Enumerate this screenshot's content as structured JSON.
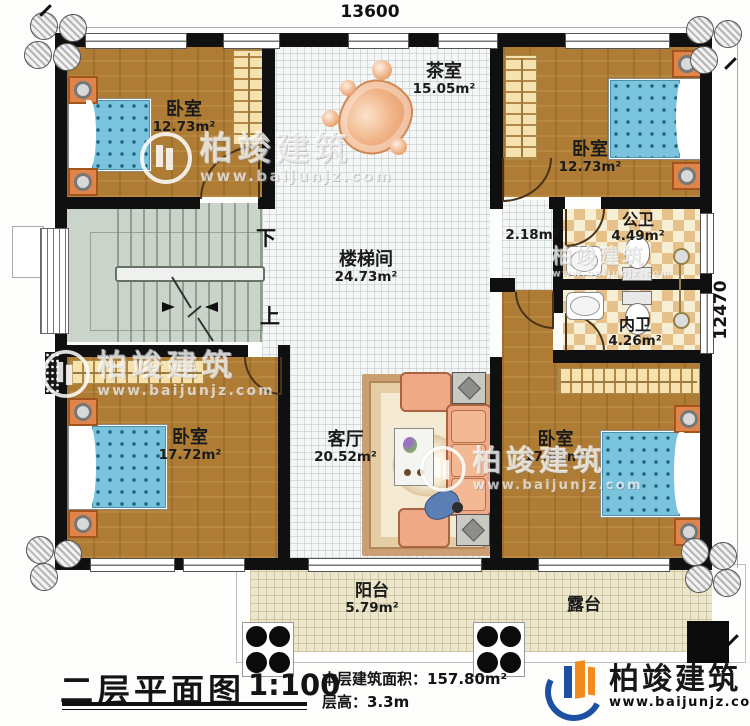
{
  "plan": {
    "dim_top": "13600",
    "dim_right": "12470",
    "rooms": {
      "bedroom_tl": {
        "name": "卧室",
        "area": "12.73m²"
      },
      "tea_room": {
        "name": "茶室",
        "area": "15.05m²"
      },
      "bedroom_tr": {
        "name": "卧室",
        "area": "12.73m²"
      },
      "stairwell": {
        "name": "楼梯间",
        "area": "24.73m²",
        "down_label": "下",
        "up_label": "上"
      },
      "hallway": {
        "area": "2.18m²"
      },
      "public_bathroom": {
        "name": "公卫",
        "area": "4.49m²"
      },
      "ensuite_bathroom": {
        "name": "内卫",
        "area": "4.26m²"
      },
      "bedroom_bl": {
        "name": "卧室",
        "area": "17.72m²"
      },
      "living_room": {
        "name": "客厅",
        "area": "20.52m²"
      },
      "bedroom_br": {
        "name": "卧室",
        "area": "17.91m²"
      },
      "balcony": {
        "name": "阳台",
        "area": "5.79m²"
      },
      "terrace": {
        "name": "露台"
      }
    }
  },
  "caption": {
    "title": "二层平面图",
    "scale": "1:100",
    "area_label": "本层建筑面积：",
    "area_value": "157.80m²",
    "height_label": "层高：",
    "height_value": "3.3m"
  },
  "branding": {
    "name": "柏竣建筑",
    "website": "www.baijunjz.com"
  },
  "watermark": {
    "name": "柏竣建筑",
    "website": "www.baijunjz.com"
  },
  "colors": {
    "wall": "#101010",
    "wood_floor": "#ae7c34",
    "tile_checker": "#e6c189",
    "stairs": "#cbd4ca",
    "bed_blanket": "#79c3dc",
    "bed_pillow": "#54bcdc",
    "nightstand": "#e08549",
    "sofa": "#efa987",
    "balcony_floor": "#ece6ce",
    "logo_blue": "#1d4fa3",
    "logo_orange": "#f28a1e"
  }
}
